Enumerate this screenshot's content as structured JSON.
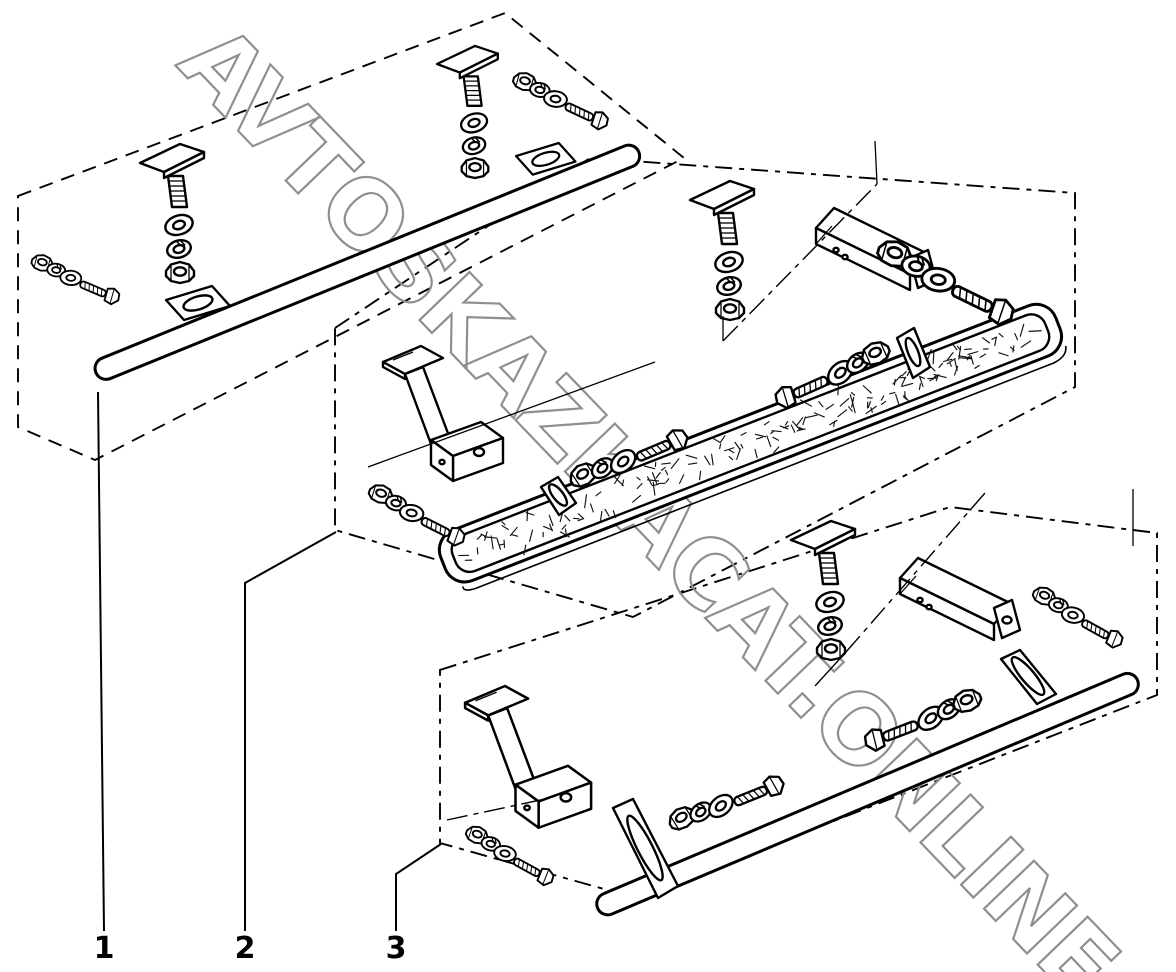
{
  "diagram": {
    "type": "exploded-parts-diagram",
    "watermark": "AVTOSKAZKACAT.ONLINE",
    "colors": {
      "ink": "#000000",
      "watermark": "#8f8f8f",
      "background": "#ffffff"
    },
    "callouts": [
      {
        "label": "1"
      },
      {
        "label": "2"
      },
      {
        "label": "3"
      }
    ],
    "assemblies": [
      {
        "callout": "1",
        "name": "tube-step-with-slotted-tabs"
      },
      {
        "callout": "2",
        "name": "plate-step-with-mounting-brackets"
      },
      {
        "callout": "3",
        "name": "tube-step-with-mounting-brackets"
      }
    ]
  }
}
